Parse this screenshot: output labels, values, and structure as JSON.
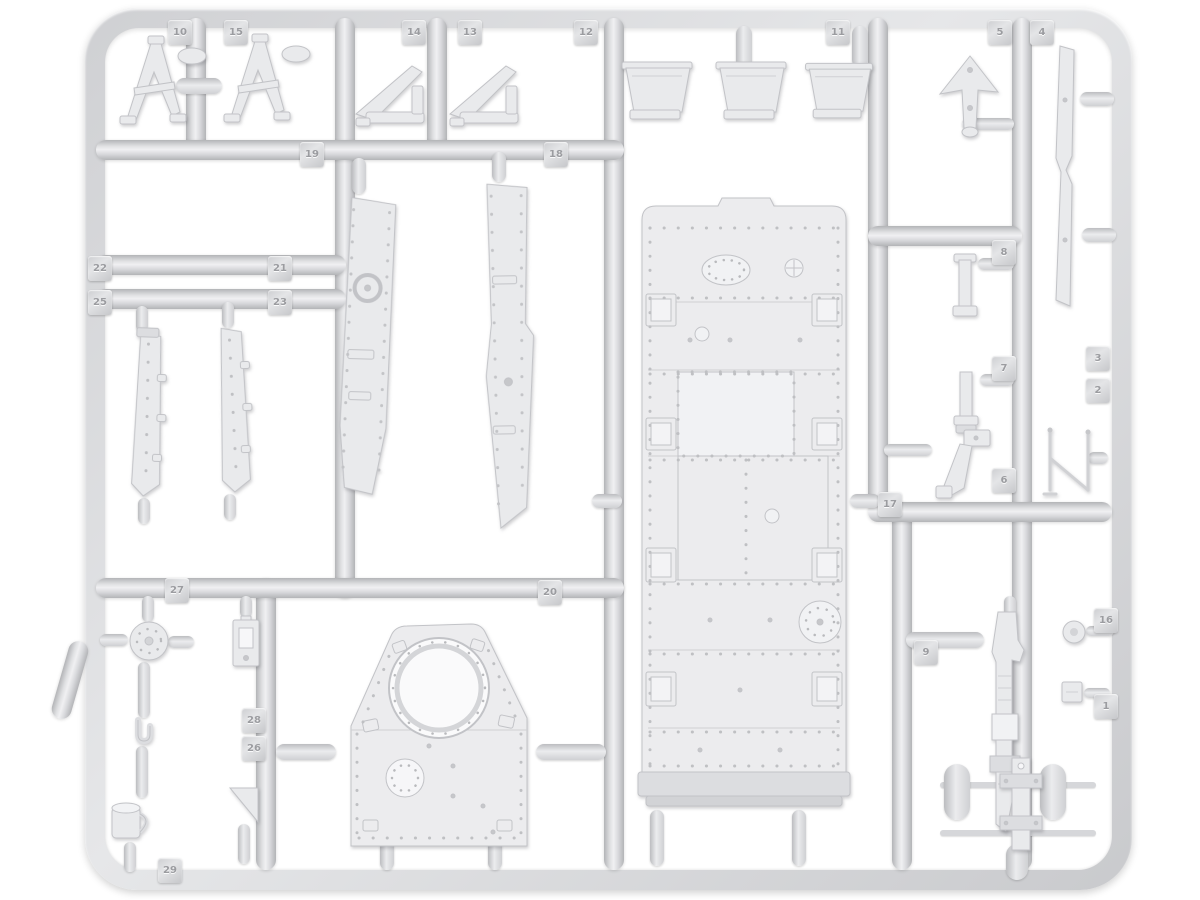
{
  "scene": {
    "description": "Light grey injection-molded styrene model kit sprue (armored vehicle parts) photographed on a white background",
    "colors": {
      "background": "#ffffff",
      "plastic_base": "#d9dadc",
      "plastic_highlight": "#f0f0f2",
      "plastic_shadow": "#b3b4b7",
      "part_fill": "#e9eaec",
      "part_outline": "#c2c3c7",
      "tag_text": "#9b9ca0"
    }
  },
  "tags": [
    {
      "label": "10"
    },
    {
      "label": "15"
    },
    {
      "label": "14"
    },
    {
      "label": "13"
    },
    {
      "label": "12"
    },
    {
      "label": "11"
    },
    {
      "label": "5"
    },
    {
      "label": "4"
    },
    {
      "label": "19"
    },
    {
      "label": "18"
    },
    {
      "label": "22"
    },
    {
      "label": "21"
    },
    {
      "label": "25"
    },
    {
      "label": "23"
    },
    {
      "label": "27"
    },
    {
      "label": "20"
    },
    {
      "label": "28"
    },
    {
      "label": "26"
    },
    {
      "label": "29"
    },
    {
      "label": "17"
    },
    {
      "label": "8"
    },
    {
      "label": "7"
    },
    {
      "label": "6"
    },
    {
      "label": "3"
    },
    {
      "label": "2"
    },
    {
      "label": "9"
    },
    {
      "label": "16"
    },
    {
      "label": "1"
    }
  ],
  "part_names": [
    "a-frame-bracket-1",
    "a-frame-bracket-2",
    "curved-fender-1",
    "curved-fender-2",
    "mudguard-1",
    "mudguard-2",
    "mudguard-3",
    "wing-bracket",
    "long-blade-strip",
    "track-guard-left",
    "track-guard-right",
    "hull-top-deck",
    "superstructure-plate",
    "fender-strip-1",
    "fender-strip-2",
    "idler-disc",
    "mount-bracket",
    "towing-hook",
    "bucket",
    "wedge-block",
    "small-bracket-1",
    "small-bracket-2",
    "support-strap",
    "antenna-frame",
    "round-knob",
    "square-plug",
    "stowage-strap",
    "strap-assembly"
  ]
}
